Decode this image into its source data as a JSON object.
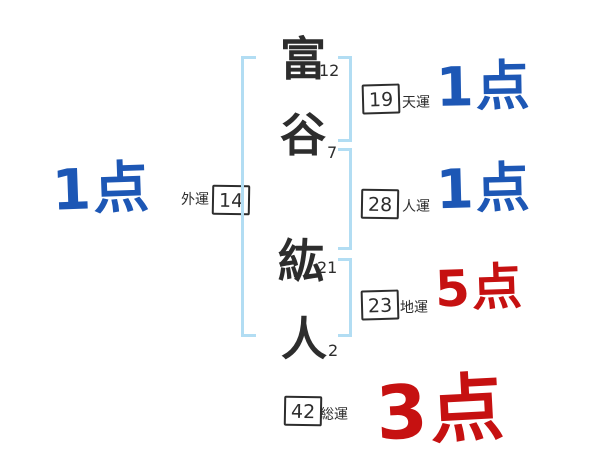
{
  "diagram": {
    "title": "name-fortune-diagram",
    "characters": [
      {
        "char": "富",
        "strokes": "12"
      },
      {
        "char": "谷",
        "strokes": "7"
      },
      {
        "char": "紘",
        "strokes": "21"
      },
      {
        "char": "人",
        "strokes": "2"
      }
    ],
    "fortunes": {
      "ten": {
        "label": "天運",
        "value": "19",
        "score": "1点"
      },
      "jin": {
        "label": "人運",
        "value": "28",
        "score": "1点"
      },
      "chi": {
        "label": "地運",
        "value": "23",
        "score": "5点"
      },
      "gai": {
        "label": "外運",
        "value": "14",
        "score": "1点"
      },
      "sou": {
        "label": "総運",
        "value": "42",
        "score": "3点"
      }
    },
    "colors": {
      "score_blue": "#1d57b5",
      "score_red": "#c61111",
      "bracket_blue": "#b2ddf3",
      "ink": "#2d2d2d"
    }
  }
}
